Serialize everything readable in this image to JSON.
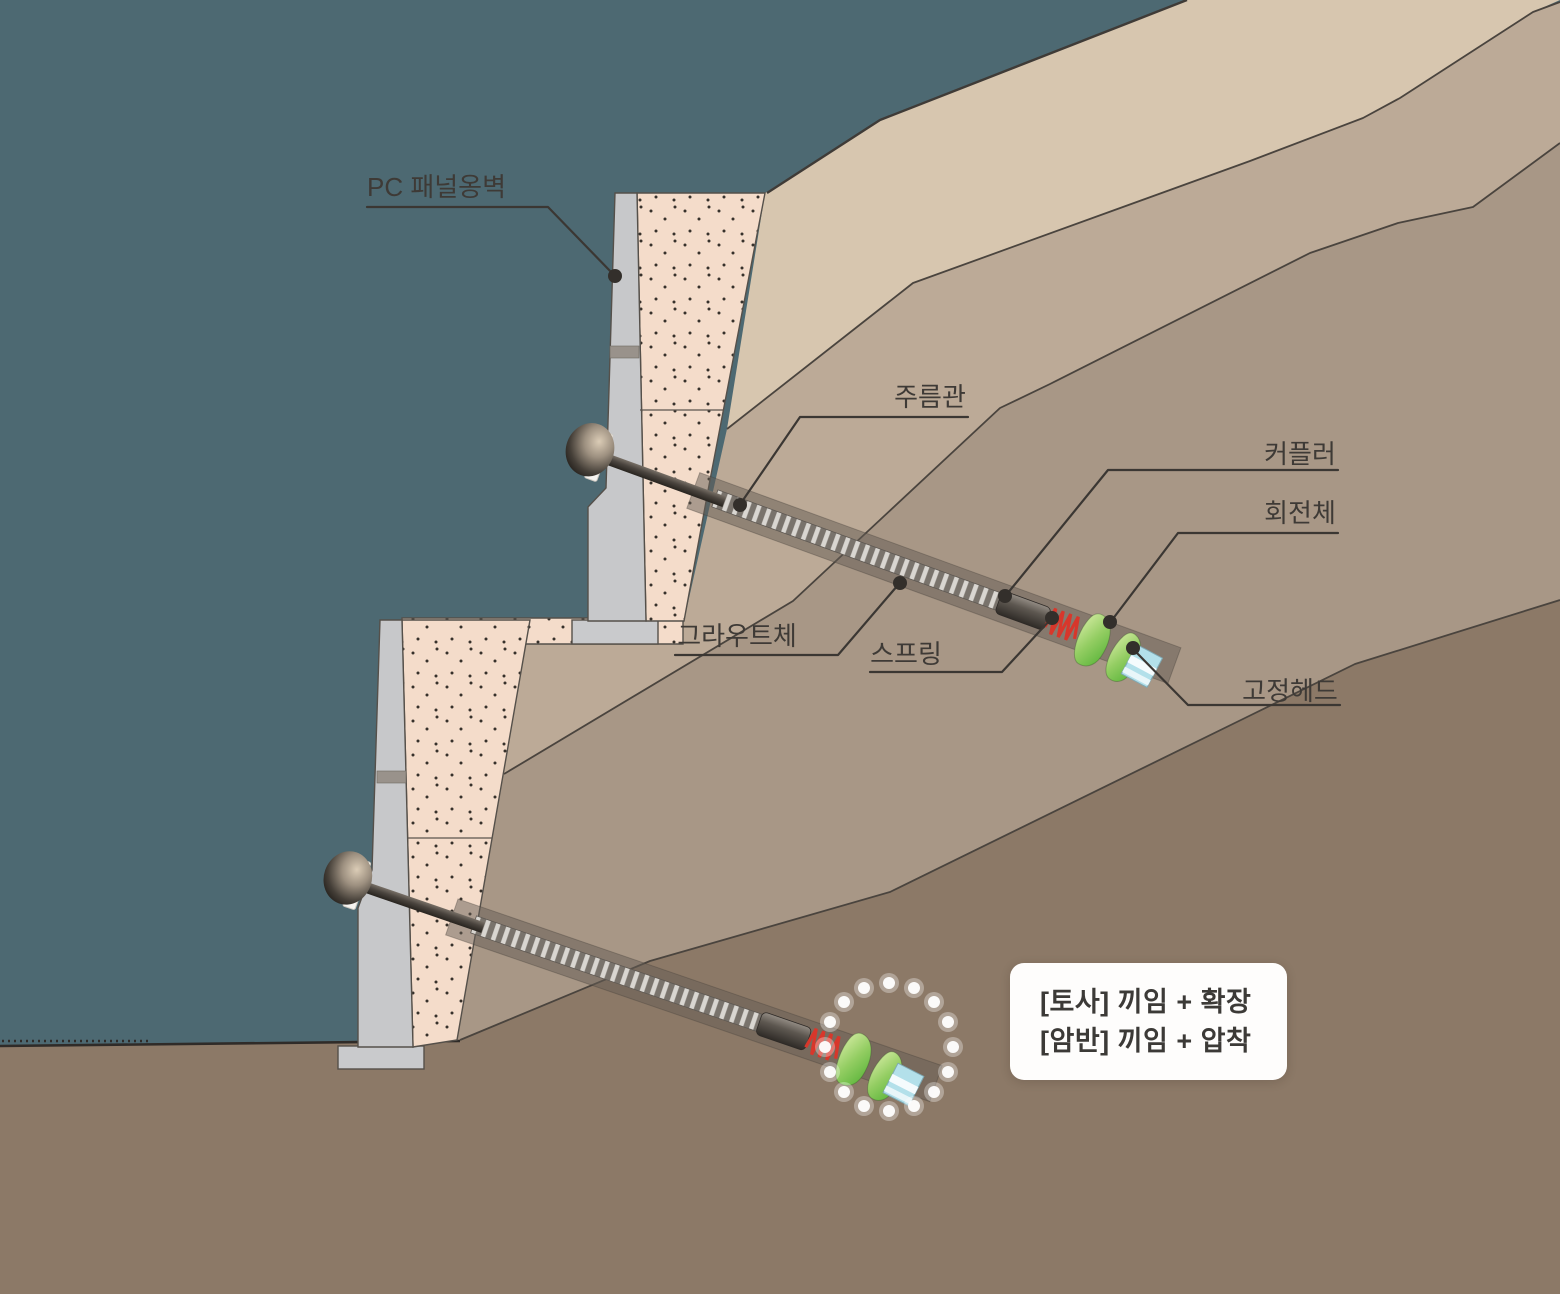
{
  "diagram": {
    "labels": {
      "wall": "PC 패널옹벽",
      "corrugated_pipe": "주름관",
      "coupler": "커플러",
      "rotating_body": "회전체",
      "grout_body": "그라우트체",
      "spring": "스프링",
      "fixed_head": "고정헤드"
    },
    "note_box": {
      "line1": "[토사] 끼임 + 확장",
      "line2": "[암반] 끼임 + 압착"
    },
    "colors": {
      "background_teal": "#4d6972",
      "soil_layer_top": "#d7c6af",
      "soil_layer_middle": "#bcaa97",
      "soil_layer_lower": "#a89786",
      "ground_brown": "#8c7967",
      "backfill_pink": "#f4dcca",
      "panel_gray": "#c7c8ca",
      "grout_sleeve_gray": "#8a8178",
      "spring_red": "#d8372b",
      "rotor_green": "#6fbf49",
      "fixed_head_blue": "#b3e0ea",
      "label_text": "#3e3a36",
      "note_box_bg": "#ffffff"
    }
  }
}
